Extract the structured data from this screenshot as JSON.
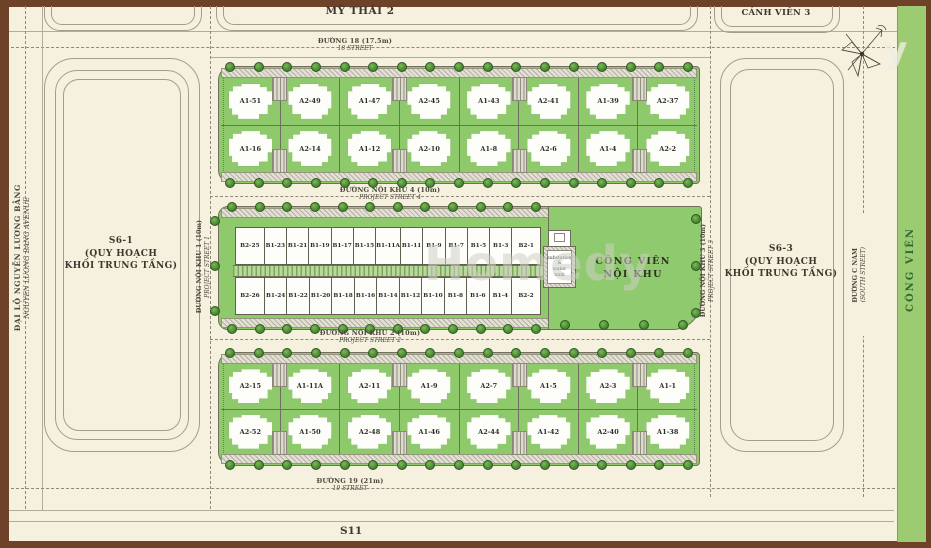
{
  "top": {
    "my_thai_2": "MỸ THÁI 2",
    "canh_vien_3": "CẢNH VIÊN 3"
  },
  "streets": {
    "duong_18": {
      "vi": "ĐƯỜNG 18 (17.5m)",
      "en": "18 STREET"
    },
    "duong_19": {
      "vi": "ĐƯỜNG 19 (21m)",
      "en": "19 STREET"
    },
    "noi_khu_1": {
      "vi": "ĐƯỜNG NỘI KHU 1 (10m)",
      "en": "PROJECT STREET 1"
    },
    "noi_khu_2": {
      "vi": "ĐƯỜNG NỘI KHU 2 (10m)",
      "en": "PROJECT STREET 2"
    },
    "noi_khu_3": {
      "vi": "ĐƯỜNG NỘI KHU 3 (10m)",
      "en": "PROJECT STREET 3"
    },
    "noi_khu_4": {
      "vi": "ĐƯỜNG NỘI KHU 4 (10m)",
      "en": "PROJECT STREET 4"
    },
    "c_nam": {
      "vi": "ĐƯỜNG C NAM",
      "en": "(SOUTH STREET)"
    },
    "avenue": {
      "vi": "ĐẠI LỘ NGUYỄN LƯƠNG BẰNG",
      "en": "NGUYEN LUONG BANG AVENUE"
    }
  },
  "blocks": {
    "s6_1": {
      "name": "S6-1",
      "line2": "(QUY HOẠCH",
      "line3": "KHỐI TRUNG TẦNG)"
    },
    "s6_3": {
      "name": "S6-3",
      "line2": "(QUY HOẠCH",
      "line3": "KHỐI TRUNG TẦNG)"
    },
    "s11": "S11",
    "park_strip": "CÔNG VIÊN"
  },
  "park": {
    "line1": "CÔNG VIÊN",
    "line2": "NỘI KHU"
  },
  "substation": {
    "line1": "substation",
    "line2": "&",
    "line3": "water tank"
  },
  "lot_rows": {
    "a_top_row1": [
      "A1-51",
      "A2-49",
      "A1-47",
      "A2-45",
      "A1-43",
      "A2-41",
      "A1-39",
      "A2-37"
    ],
    "a_top_row2": [
      "A1-16",
      "A2-14",
      "A1-12",
      "A2-10",
      "A1-8",
      "A2-6",
      "A1-4",
      "A2-2"
    ],
    "b_row1": [
      "B2-25",
      "B1-23",
      "B1-21",
      "B1-19",
      "B1-17",
      "B1-15",
      "B1-11A",
      "B1-11",
      "B1-9",
      "B1-7",
      "B1-5",
      "B1-3",
      "B2-1"
    ],
    "b_row2": [
      "B2-26",
      "B1-24",
      "B1-22",
      "B1-20",
      "B1-18",
      "B1-16",
      "B1-14",
      "B1-12",
      "B1-10",
      "B1-8",
      "B1-6",
      "B1-4",
      "B2-2"
    ],
    "a_bottom_row1": [
      "A2-15",
      "A1-11A",
      "A2-11",
      "A1-9",
      "A2-7",
      "A1-5",
      "A2-3",
      "A1-1"
    ],
    "a_bottom_row2": [
      "A2-52",
      "A1-50",
      "A2-48",
      "A1-46",
      "A2-44",
      "A1-42",
      "A2-40",
      "A1-38"
    ]
  },
  "watermark": {
    "text": "Homedy",
    "partial": "y"
  },
  "colors": {
    "lot_green": "#8ec96c",
    "strip_green": "#9ccb72",
    "tree_green": "#396f2b",
    "frame_brown": "#6e4129",
    "background": "#f6f1de"
  }
}
